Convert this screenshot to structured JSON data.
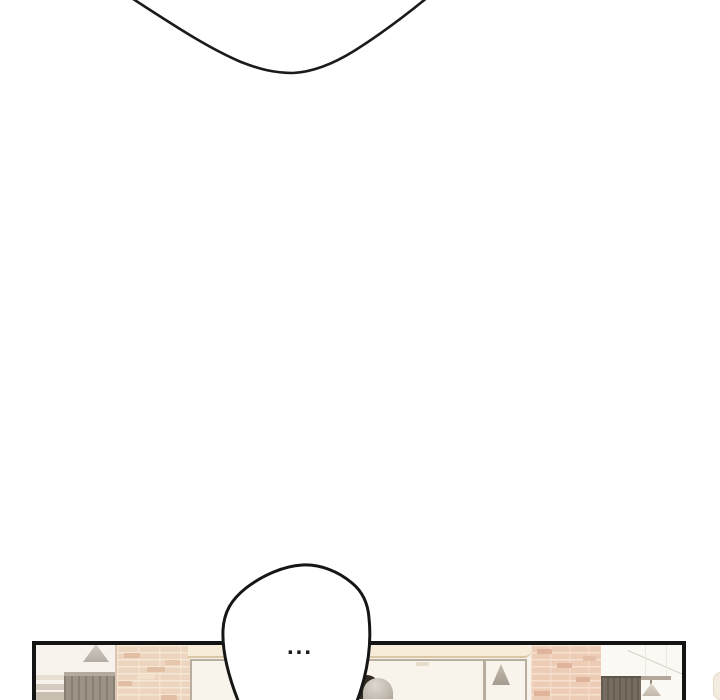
{
  "speech_bubble": {
    "text": "...",
    "fill": "#ffffff",
    "stroke": "#161616"
  },
  "top_balloon": {
    "shape": "bottom-arc-of-large-speech-balloon",
    "stroke": "#1b1b1b"
  },
  "panel": {
    "scene": "storefront-exterior",
    "border_color": "#141414",
    "background": "#f7f3ec"
  },
  "colors": {
    "ink": "#1a1a1a",
    "brick_left": "#ecd4be",
    "brick_right": "#edccb5",
    "mortar": "#f6e8d7",
    "fascia": "#f6ecd7",
    "window_frame": "#b8aea0",
    "window_glass": "#f9f4eb",
    "crate": "#9c9387",
    "drape": "#766c5f",
    "lamp_shade": "#ded7cb",
    "ornament_gray": "#c9c3ba"
  }
}
